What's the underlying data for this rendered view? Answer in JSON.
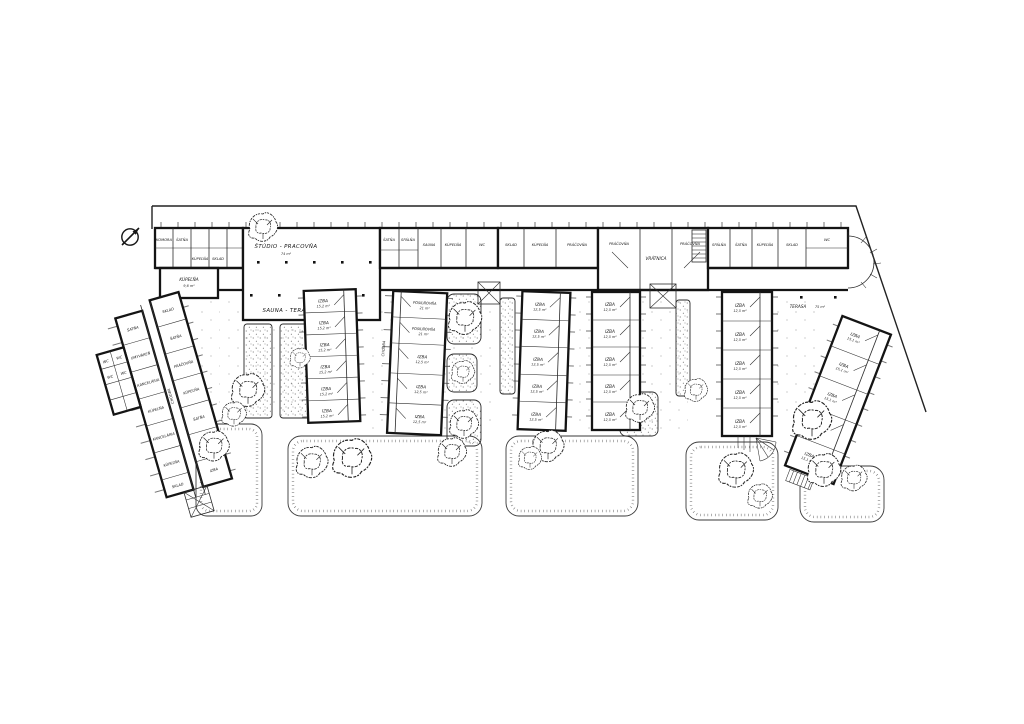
{
  "plan": {
    "kind": "site-floor-plan",
    "paper_color": "#ffffff",
    "ink_color": "#161616"
  },
  "labels": {
    "hall": "ŠTÚDIO - PRACOVŇA",
    "hall_area": "74 m²",
    "sauna_terrace": "SAUNA - TERASA",
    "terrace": "TERASA",
    "terrace_area": "75 m²",
    "reception": "VRÁTNICA",
    "laundry_left": "PRÁČOVŇA",
    "laundry_right": "PRÁČOVŇA",
    "corridor": "CHODBA",
    "bath_left": "KÚPEĽŇA",
    "bath_left_area": "9,6 m²",
    "wc": "WC",
    "top_left_rooms": [
      "KOMORA",
      "ŠATŇA",
      "KÚPEĽŇA",
      "SKLAD"
    ],
    "top_c_rooms": [
      "ŠATŇA",
      "SPÁLŇA",
      "SAUNA",
      "KÚPEĽŇA",
      "WC"
    ],
    "top_d_rooms": [
      "SKLAD",
      "KÚPEĽŇA",
      "PRÁČOVŇA"
    ],
    "top_f_rooms": [
      "SPÁLŇA",
      "ŠATŇA",
      "KÚPEĽŇA",
      "SKLAD"
    ]
  },
  "wing_west": {
    "corridor": "CHODBA",
    "left_rooms": [
      "ŠATŇA",
      "UMYVÁREŇ",
      "KANCELÁRIA",
      "KÚPEĽŇA",
      "KANCELÁRIA",
      "KÚPEĽŇA",
      "SKLAD"
    ],
    "right_rooms": [
      "SKLAD",
      "ŠATŇA",
      "PRÁČOVŇA",
      "KÚPEĽŇA",
      "ŠATŇA",
      "KÚPEĽŇA",
      "IZBA"
    ],
    "wc_cells": [
      "WC",
      "WC",
      "WC",
      "WC"
    ]
  },
  "wings": {
    "w2": {
      "corridor": "CHODBA",
      "rooms": [
        {
          "label": "IZBA",
          "area": "15,2 m²"
        },
        {
          "label": "IZBA",
          "area": "15,2 m²"
        },
        {
          "label": "IZBA",
          "area": "15,2 m²"
        },
        {
          "label": "IZBA",
          "area": "15,2 m²"
        },
        {
          "label": "IZBA",
          "area": "15,2 m²"
        },
        {
          "label": "IZBA",
          "area": "15,2 m²"
        }
      ]
    },
    "w3": {
      "corridor": "CHODBA",
      "top_rooms": [
        {
          "label": "POSILŇOVŇA",
          "area": "21 m²"
        },
        {
          "label": "POSILŇOVŇA",
          "area": "21 m²"
        }
      ],
      "rooms": [
        {
          "label": "IZBA",
          "area": "12,5 m²"
        },
        {
          "label": "IZBA",
          "area": "12,5 m²"
        },
        {
          "label": "IZBA",
          "area": "12,5 m²"
        }
      ]
    },
    "w4": {
      "rooms": [
        {
          "label": "IZBA",
          "area": "12,5 m²"
        },
        {
          "label": "IZBA",
          "area": "12,5 m²"
        },
        {
          "label": "IZBA",
          "area": "12,5 m²"
        },
        {
          "label": "IZBA",
          "area": "12,5 m²"
        },
        {
          "label": "IZBA",
          "area": "12,5 m²"
        }
      ]
    },
    "w5": {
      "rooms": [
        {
          "label": "IZBA",
          "area": "12,5 m²"
        },
        {
          "label": "IZBA",
          "area": "12,5 m²"
        },
        {
          "label": "IZBA",
          "area": "12,5 m²"
        },
        {
          "label": "IZBA",
          "area": "12,5 m²"
        },
        {
          "label": "IZBA",
          "area": "12,5 m²"
        }
      ]
    },
    "w6": {
      "rooms": [
        {
          "label": "IZBA",
          "area": "12,5 m²"
        },
        {
          "label": "IZBA",
          "area": "12,5 m²"
        },
        {
          "label": "IZBA",
          "area": "12,5 m²"
        },
        {
          "label": "IZBA",
          "area": "12,5 m²"
        },
        {
          "label": "IZBA",
          "area": "12,5 m²"
        }
      ]
    },
    "w7": {
      "rooms": [
        {
          "label": "IZBA",
          "area": "15,1 m²"
        },
        {
          "label": "IZBA",
          "area": "15,1 m²"
        },
        {
          "label": "IZBA",
          "area": "15,1 m²"
        },
        {
          "label": "IZBA",
          "area": "15,1 m²"
        },
        {
          "label": "IZBA",
          "area": "15,1 m²"
        }
      ]
    }
  }
}
